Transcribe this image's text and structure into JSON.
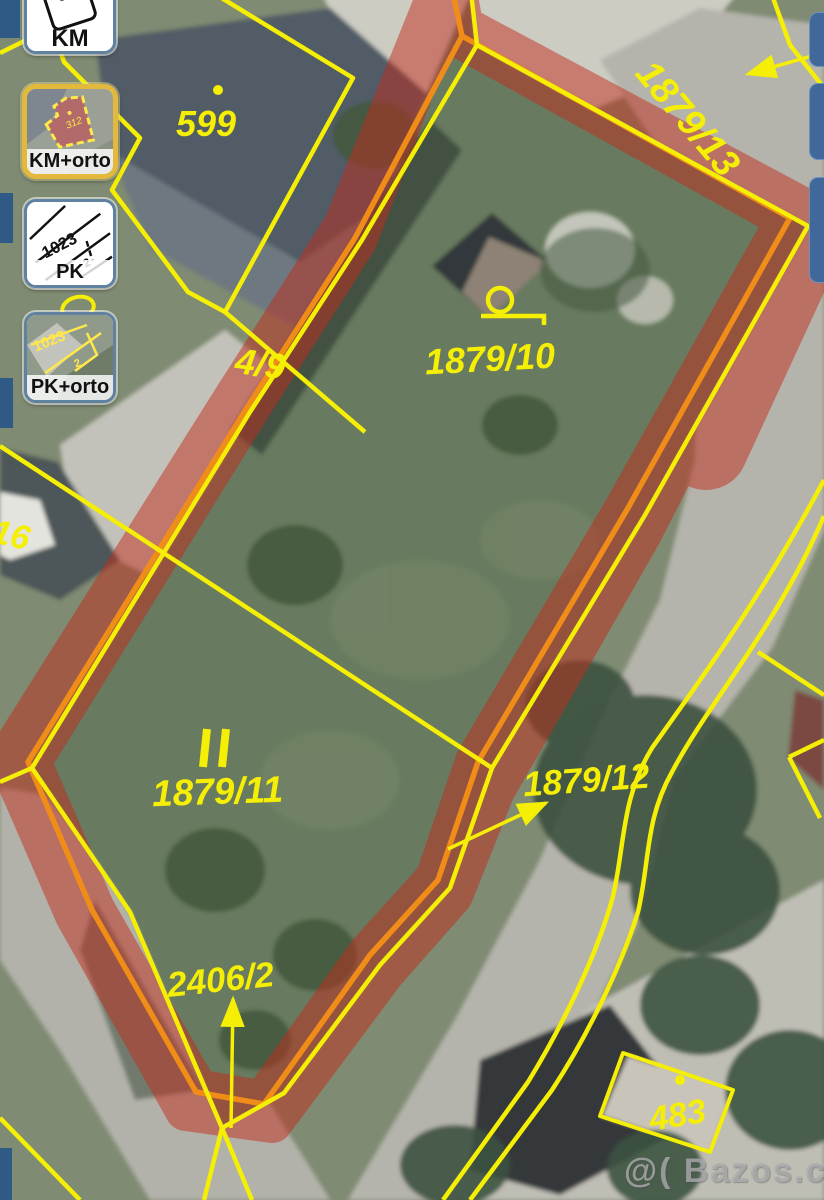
{
  "map": {
    "description": "cadastral ortho map with highlighted parcel",
    "labels": [
      {
        "id": "599",
        "text": "599"
      },
      {
        "id": "1879-13",
        "text": "1879/13"
      },
      {
        "id": "1879-10",
        "text": "1879/10"
      },
      {
        "id": "1879-11",
        "text": "1879/11"
      },
      {
        "id": "1879-12",
        "text": "1879/12"
      },
      {
        "id": "2406-2",
        "text": "2406/2"
      },
      {
        "id": "483",
        "text": "483"
      },
      {
        "id": "16",
        "text": "16"
      },
      {
        "id": "4-9",
        "text": "4/9"
      }
    ],
    "watermark": "@( Bazos.cz"
  },
  "layer_buttons": [
    {
      "label": "KM",
      "thumb_text": "300",
      "selected": false
    },
    {
      "label": "KM+orto",
      "thumb_text": "312",
      "selected": true
    },
    {
      "label": "PK",
      "thumb_text": "1023",
      "selected": false
    },
    {
      "label": "PK+orto",
      "thumb_text": "1023",
      "selected": false
    }
  ],
  "colors": {
    "cadastral_yellow": "#f5ee05",
    "highlight_orange": "#f08c18",
    "highlight_red": "#c22c1d",
    "selected_border_gold": "#e2b93c",
    "panel_blue": "#41689b"
  }
}
